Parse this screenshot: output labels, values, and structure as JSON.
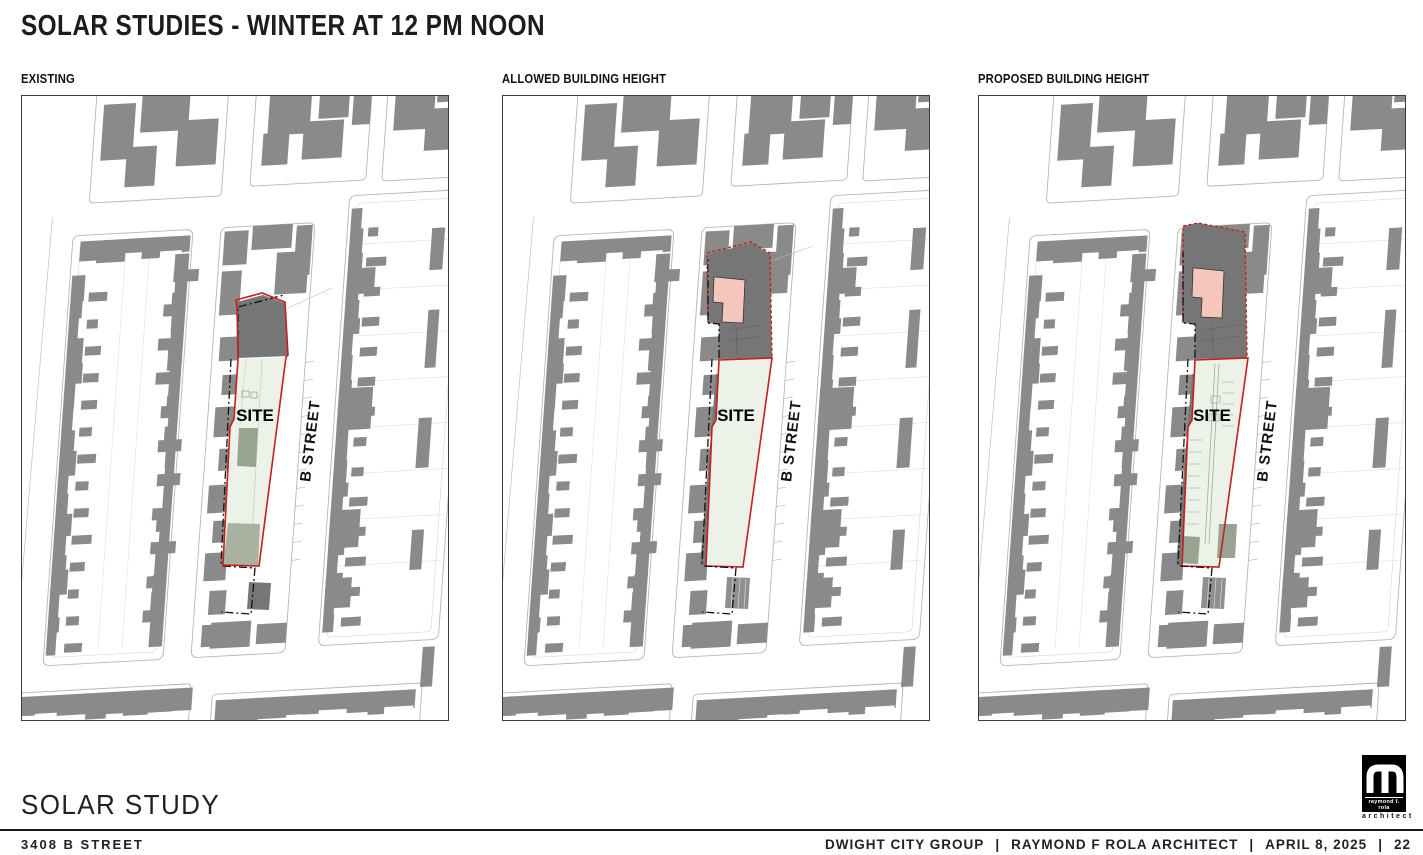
{
  "title": "SOLAR STUDIES - WINTER AT 12 PM NOON",
  "panels": [
    {
      "id": "existing",
      "label": "EXISTING",
      "site_label": "SITE",
      "street_label": "B STREET"
    },
    {
      "id": "allowed",
      "label": "ALLOWED BUILDING HEIGHT",
      "site_label": "SITE",
      "street_label": "B STREET"
    },
    {
      "id": "proposed",
      "label": "PROPOSED BUILDING HEIGHT",
      "site_label": "SITE",
      "street_label": "B STREET"
    }
  ],
  "footer": {
    "project_title": "SOLAR STUDY",
    "address": "3408 B STREET",
    "credit_1": "DWIGHT CITY GROUP",
    "credit_2": "RAYMOND F ROLA ARCHITECT",
    "credit_3": "APRIL 8, 2025",
    "separator": "|",
    "page_number": "22"
  },
  "logo": {
    "line1": "raymond f. rola",
    "line2": "architect"
  },
  "colors": {
    "site_green": "#ecf2e8",
    "shadow_gray": "#767676",
    "building_gray": "#8a8a8a",
    "proposed_pink": "#f5c6bb",
    "site_outline_red": "#c4201c",
    "block_outline_gray": "#b5b5b5",
    "existing_building_on_site": "#99a391",
    "rear_yard_green_gray": "#a9b2a0"
  }
}
